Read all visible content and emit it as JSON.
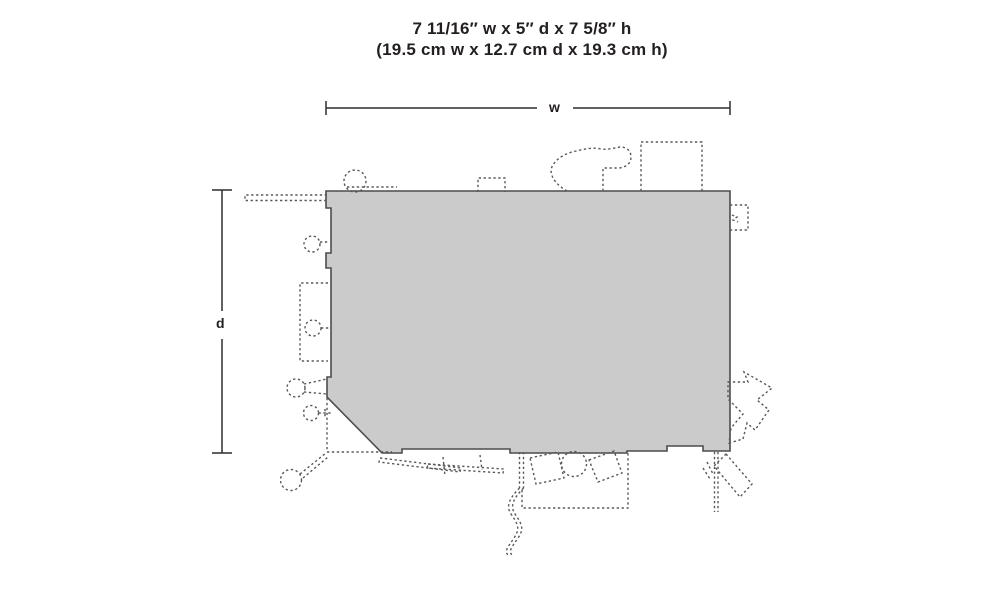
{
  "page": {
    "background": "#ffffff"
  },
  "title": {
    "imperial": "7 11/16″ w x 5″ d x 7 5/8″ h",
    "metric": "(19.5 cm w x 12.7 cm d x 19.3 cm h)"
  },
  "dimensions": {
    "width": {
      "label": "w",
      "imperial": "7 11/16″",
      "metric": "19.5 cm"
    },
    "depth": {
      "label": "d",
      "imperial": "5″",
      "metric": "12.7 cm"
    },
    "height": {
      "imperial": "7 5/8″",
      "metric": "19.3 cm"
    }
  },
  "colors": {
    "footprint_fill": "#cbcbcc",
    "footprint_outline": "#4c4c4e",
    "detail_dash": "#58585a",
    "dimension_line": "#2d2d2f",
    "text": "#231f20"
  },
  "diagram": {
    "kind": "building footprint top view with dashed accessory outlines",
    "details": [
      "board-stack-left",
      "round-vent-top",
      "small-box-top",
      "junk-pile-top",
      "large-box-top",
      "meter-box-right",
      "barrel-left-upper",
      "rack-left",
      "barrel-left-mid",
      "post-with-braces-left",
      "valve-left-lower",
      "lamp-post-bottom-left",
      "fallen-boards-bottom",
      "hanging-hose-bottom",
      "loading-pad-bottom",
      "crate-bottom-1",
      "barrel-bottom",
      "crate-bottom-2",
      "arrow-sign-right",
      "ramp-bottom-right",
      "post-bottom-right"
    ]
  }
}
